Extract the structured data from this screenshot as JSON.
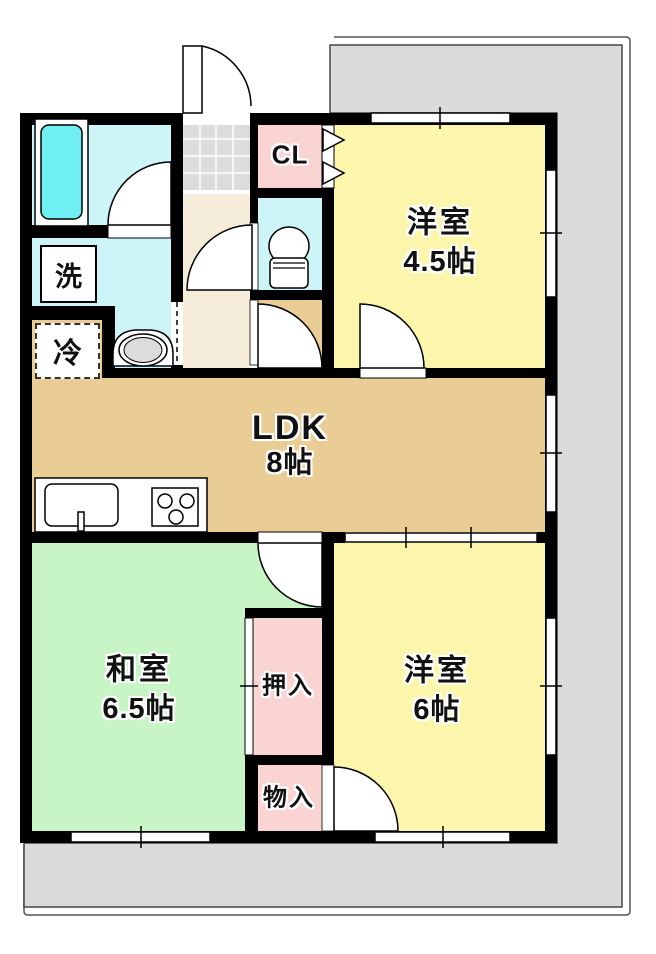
{
  "rooms": {
    "western_room_top": {
      "name": "洋室",
      "size": "4.5帖"
    },
    "ldk": {
      "name": "LDK",
      "size": "8帖"
    },
    "japanese_room": {
      "name": "和室",
      "size": "6.5帖"
    },
    "western_room_bottom": {
      "name": "洋室",
      "size": "6帖"
    },
    "closet": {
      "label": "CL"
    },
    "oshiire": {
      "label": "押入"
    },
    "storage": {
      "label": "物入"
    },
    "laundry": {
      "label": "洗"
    },
    "refrigerator": {
      "label": "冷"
    }
  },
  "colors": {
    "western_room": "#FBF6AC",
    "ldk": "#EACD95",
    "japanese_room": "#C8F5C6",
    "closet_pink": "#FAD3D3",
    "wet_area": "#CDF4F6",
    "bathtub": "#6FEFF2",
    "corridor": "#F5EDDA",
    "tile_gray": "#DCDCDC",
    "balcony": "#DBDBDB",
    "wall": "#000000"
  }
}
